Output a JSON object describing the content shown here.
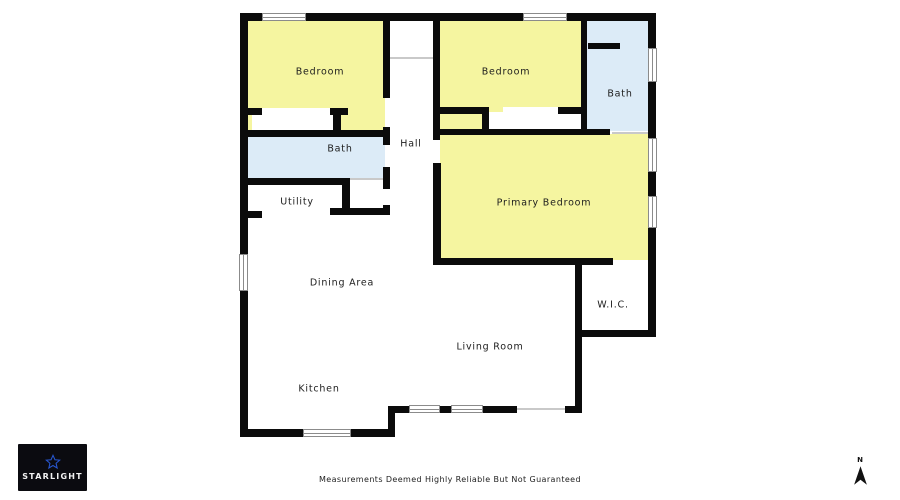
{
  "palette": {
    "wall": "#0b0b0b",
    "room_yellow": "#F5F5A0",
    "room_blue": "#DCEBF7",
    "window_frame": "#8b8b8b",
    "opening_line": "#c9c9c9",
    "label_color": "#1c1c1c",
    "logo_bg": "#0b0b10",
    "logo_star": "#2857d0",
    "logo_text_color": "#f2f2f2",
    "compass_color": "#111111",
    "disclaimer_color": "#222222"
  },
  "floorplan": {
    "rooms": [
      {
        "name": "bedroom-1",
        "fill": "room_yellow",
        "x": 246,
        "y": 19,
        "w": 139,
        "h": 118
      },
      {
        "name": "bedroom-2",
        "fill": "room_yellow",
        "x": 440,
        "y": 19,
        "w": 141,
        "h": 118
      },
      {
        "name": "bath-2",
        "fill": "room_blue",
        "x": 585,
        "y": 19,
        "w": 65,
        "h": 112
      },
      {
        "name": "bath-1",
        "fill": "room_blue",
        "x": 246,
        "y": 133,
        "w": 139,
        "h": 46
      },
      {
        "name": "primary-bedroom",
        "fill": "room_yellow",
        "x": 440,
        "y": 134,
        "w": 210,
        "h": 126
      }
    ],
    "cutouts": [
      {
        "name": "closet-1",
        "x": 252,
        "y": 112,
        "w": 81,
        "h": 20
      },
      {
        "name": "closet-1-opening",
        "x": 262,
        "y": 108,
        "w": 68,
        "h": 8
      },
      {
        "name": "closet-2",
        "x": 489,
        "y": 112,
        "w": 92,
        "h": 20
      },
      {
        "name": "closet-2-opening",
        "x": 503,
        "y": 107,
        "w": 55,
        "h": 8
      }
    ],
    "walls": [
      [
        240,
        13,
        416,
        8
      ],
      [
        240,
        13,
        8,
        424
      ],
      [
        240,
        429,
        155,
        8
      ],
      [
        388,
        406,
        7,
        31
      ],
      [
        395,
        406,
        122,
        7
      ],
      [
        565,
        406,
        17,
        7
      ],
      [
        575,
        262,
        7,
        151
      ],
      [
        575,
        330,
        81,
        7
      ],
      [
        648,
        13,
        8,
        324
      ],
      [
        248,
        108,
        14,
        7
      ],
      [
        330,
        108,
        18,
        7
      ],
      [
        333,
        108,
        8,
        29
      ],
      [
        240,
        130,
        150,
        7
      ],
      [
        240,
        178,
        110,
        7
      ],
      [
        342,
        178,
        8,
        37
      ],
      [
        240,
        211,
        22,
        7
      ],
      [
        330,
        208,
        60,
        7
      ],
      [
        383,
        21,
        7,
        77
      ],
      [
        383,
        127,
        7,
        18
      ],
      [
        383,
        167,
        7,
        22
      ],
      [
        383,
        205,
        7,
        10
      ],
      [
        433,
        21,
        7,
        119
      ],
      [
        433,
        163,
        8,
        100
      ],
      [
        440,
        129,
        170,
        6
      ],
      [
        433,
        258,
        180,
        7
      ],
      [
        581,
        21,
        6,
        114
      ],
      [
        588,
        43,
        32,
        6
      ],
      [
        440,
        107,
        42,
        7
      ],
      [
        482,
        107,
        7,
        28
      ],
      [
        558,
        107,
        23,
        7
      ]
    ],
    "windows": [
      [
        262,
        13,
        44,
        8
      ],
      [
        523,
        13,
        44,
        8
      ],
      [
        239,
        254,
        9,
        37
      ],
      [
        648,
        48,
        9,
        34
      ],
      [
        648,
        138,
        9,
        34
      ],
      [
        648,
        196,
        9,
        32
      ],
      [
        303,
        429,
        48,
        8
      ],
      [
        409,
        405,
        31,
        8
      ],
      [
        451,
        405,
        32,
        8
      ]
    ],
    "opening_lines": [
      [
        390,
        57,
        43,
        2
      ],
      [
        350,
        178,
        33,
        2
      ],
      [
        517,
        408,
        48,
        2
      ],
      [
        612,
        132,
        36,
        2
      ]
    ],
    "labels": [
      {
        "text": "Bedroom",
        "cx": 320,
        "cy": 72
      },
      {
        "text": "Bedroom",
        "cx": 506,
        "cy": 72
      },
      {
        "text": "Bath",
        "cx": 620,
        "cy": 94
      },
      {
        "text": "Hall",
        "cx": 411,
        "cy": 144
      },
      {
        "text": "Bath",
        "cx": 340,
        "cy": 149
      },
      {
        "text": "Utility",
        "cx": 297,
        "cy": 202
      },
      {
        "text": "Primary Bedroom",
        "cx": 544,
        "cy": 203
      },
      {
        "text": "Dining Area",
        "cx": 342,
        "cy": 283
      },
      {
        "text": "W.I.C.",
        "cx": 613,
        "cy": 305
      },
      {
        "text": "Living Room",
        "cx": 490,
        "cy": 347
      },
      {
        "text": "Kitchen",
        "cx": 319,
        "cy": 389
      }
    ]
  },
  "branding": {
    "logo_text": "STARLIGHT"
  },
  "footer": {
    "disclaimer": "Measurements Deemed Highly Reliable But Not Guaranteed"
  },
  "compass": {
    "label": "N"
  }
}
